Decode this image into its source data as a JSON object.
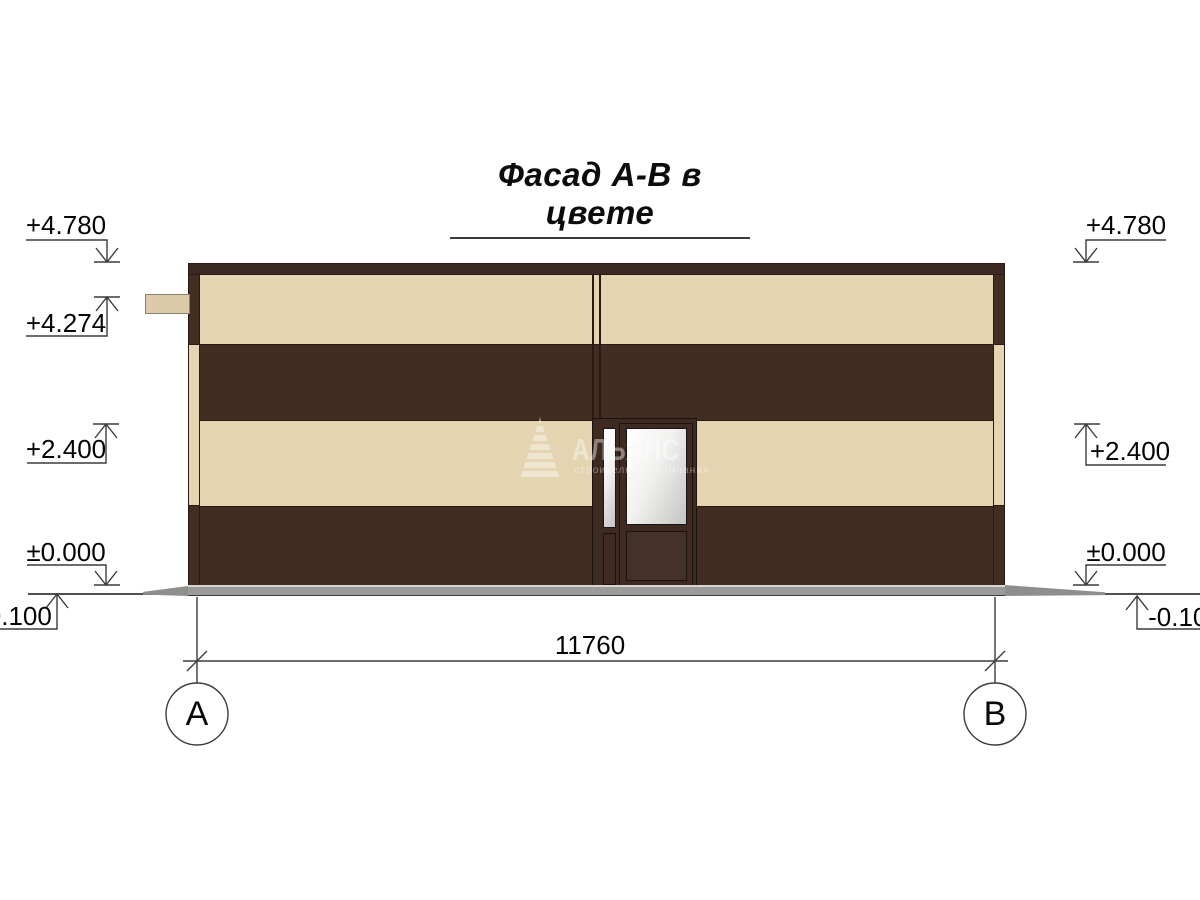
{
  "title": "Фасад А-В в цвете",
  "drawing": {
    "type": "facade-elevation",
    "dimension_total": "11760",
    "axes": [
      {
        "label": "А"
      },
      {
        "label": "В"
      }
    ],
    "elevations_left": [
      {
        "label": "+4.780"
      },
      {
        "label": "+4.274"
      },
      {
        "label": "+2.400"
      },
      {
        "label": "±0.000"
      },
      {
        "label": "-0.100"
      }
    ],
    "elevations_right": [
      {
        "label": "+4.780"
      },
      {
        "label": "+2.400"
      },
      {
        "label": "±0.000"
      },
      {
        "label": "-0.100"
      }
    ]
  },
  "watermark": {
    "brand": "АЛЬЯНС",
    "subtitle": "строительная компания"
  },
  "colors": {
    "wall-dark": "#422d23",
    "wall-beige": "#e4d4b2",
    "cornice": "#3b2821",
    "outline": "#2a1a12",
    "door-frame": "#3e2a21",
    "glass-a": "#ffffff",
    "glass-b": "#c4c4c2",
    "plinth": "#9b9b99",
    "blind-area": "#8e8e8c",
    "ground": "#4f4f4f",
    "drawing-line": "#3c3c3c",
    "beam": "#dccaa8"
  }
}
